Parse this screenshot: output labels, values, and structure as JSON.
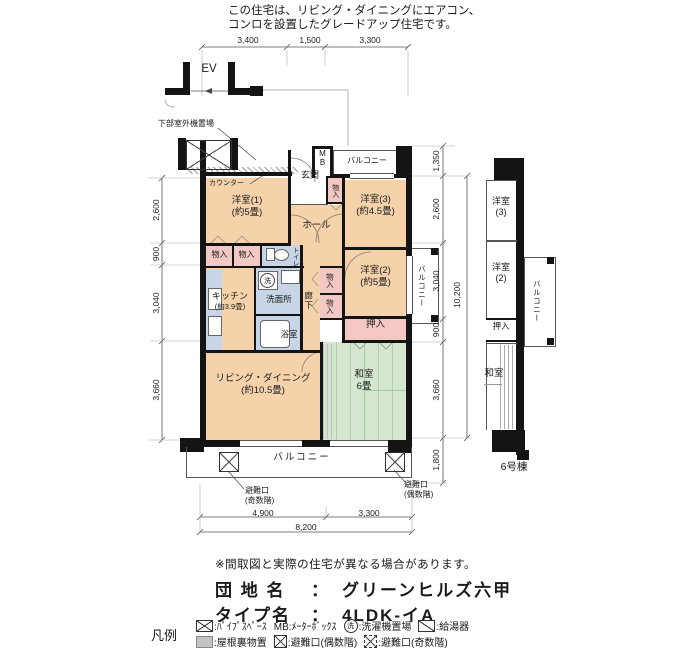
{
  "header": {
    "line1": "この住宅は、リビング・ダイニングにエアコン、",
    "line2": "コンロを設置したグレードアップ住宅です。"
  },
  "plan": {
    "ev": "EV",
    "outdoor_unit": "下部室外機置場",
    "counter": "カウンター",
    "mb_m": "M",
    "mb_b": "B",
    "balcony_top": "バルコニー",
    "balcony_right": "バルコニー",
    "balcony_bottom": "バルコニー",
    "closet": "物入",
    "wash_symbol": "洗",
    "rooms": {
      "y1_name": "洋室(1)",
      "y1_size": "(約5畳)",
      "y2_name": "洋室(2)",
      "y2_size": "(約5畳)",
      "y3_name": "洋室(3)",
      "y3_size": "(約4.5畳)",
      "genkan": "玄関",
      "hall": "ホール",
      "kitchen_name": "キッチン",
      "kitchen_size": "(約3.9畳)",
      "senmenjo": "洗面所",
      "bath": "浴室",
      "toilet": "トイレ",
      "corridor": "廊下",
      "living_name": "リビング・ダイニング",
      "living_size": "(約10.5畳)",
      "washitsu_name": "和室",
      "washitsu_size": "6畳",
      "oshiire": "押入"
    },
    "escape_odd_1": "避難口",
    "escape_odd_2": "(奇数階)",
    "escape_even_1": "避難口",
    "escape_even_2": "(偶数階)"
  },
  "dims": {
    "top": [
      "3,400",
      "1,500",
      "3,300"
    ],
    "left": [
      "2,600",
      "900",
      "3,040",
      "3,660"
    ],
    "right": [
      "1,350",
      "2,600",
      "3,040",
      "900",
      "3,660",
      "1,800"
    ],
    "right_total": "10,200",
    "bottom": [
      "4,900",
      "3,300"
    ],
    "bottom_total": "8,200"
  },
  "section": {
    "y3_name": "洋室",
    "y3_num": "(3)",
    "y2_name": "洋室",
    "y2_num": "(2)",
    "oshiire": "押入",
    "washitsu": "和室",
    "balcony": "バルコニー",
    "building": "6号棟"
  },
  "footer": {
    "note": "※間取図と実際の住宅が異なる場合があります。",
    "estate_label": "団 地 名",
    "colon": "：",
    "estate_name": "グリーンヒルズ六甲",
    "type_label": "タイプ名",
    "type_name": "4LDK-イA",
    "legend_title": "凡例",
    "legend": {
      "pipe": ":ﾊﾟｲﾌﾟｽﾍﾟｰｽ",
      "mb": "MB:ﾒｰﾀｰﾎﾞｯｸｽ",
      "wash_symbol": "洗",
      "wash": ":洗濯機置場",
      "boiler": ":給湯器",
      "attic": ":屋根裏物置",
      "escape_even": ":避難口(偶数階)",
      "escape_odd": ":避難口(奇数階)"
    }
  },
  "colors": {
    "room_peach": "#f6d2ab",
    "closet_pink": "#f3c7c3",
    "wet_blue": "#c8d5e6",
    "tatami_green": "#d4e6cf",
    "wall": "#141414"
  }
}
